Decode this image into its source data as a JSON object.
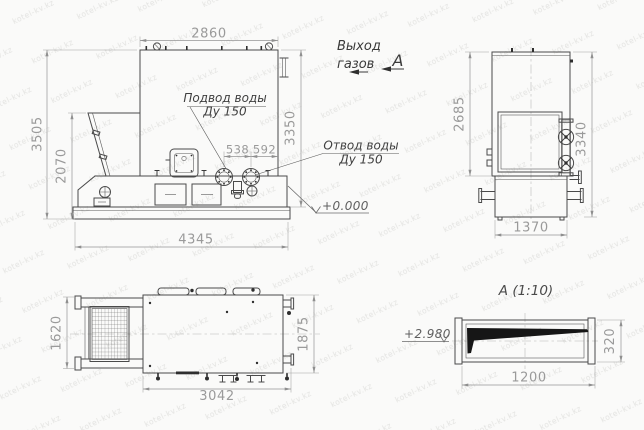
{
  "watermark": {
    "text": "kotel-kv.kz"
  },
  "annotations": {
    "gas_outlet": {
      "line1": "Выход",
      "line2": "газов"
    },
    "view_letter": "А",
    "water_inlet": {
      "line1": "Подвод воды",
      "line2": "Ду 150"
    },
    "water_outlet": {
      "line1": "Отвод воды",
      "line2": "Ду 150"
    },
    "level_base": "+0.000",
    "level_duct": "+2.980",
    "detail_title": "А (1:10)"
  },
  "dimensions": {
    "front_width": "2860",
    "front_height_total": "3505",
    "front_hopper_height": "2070",
    "front_body_height": "3350",
    "front_flange_span_1": "538",
    "front_flange_span_2": "592",
    "front_base_length": "4345",
    "side_upper_height": "2685",
    "side_total_height": "3340",
    "side_base_width": "1370",
    "plan_grate_width": "1620",
    "plan_body_width": "1875",
    "plan_length": "3042",
    "detail_height": "320",
    "detail_width": "1200"
  }
}
